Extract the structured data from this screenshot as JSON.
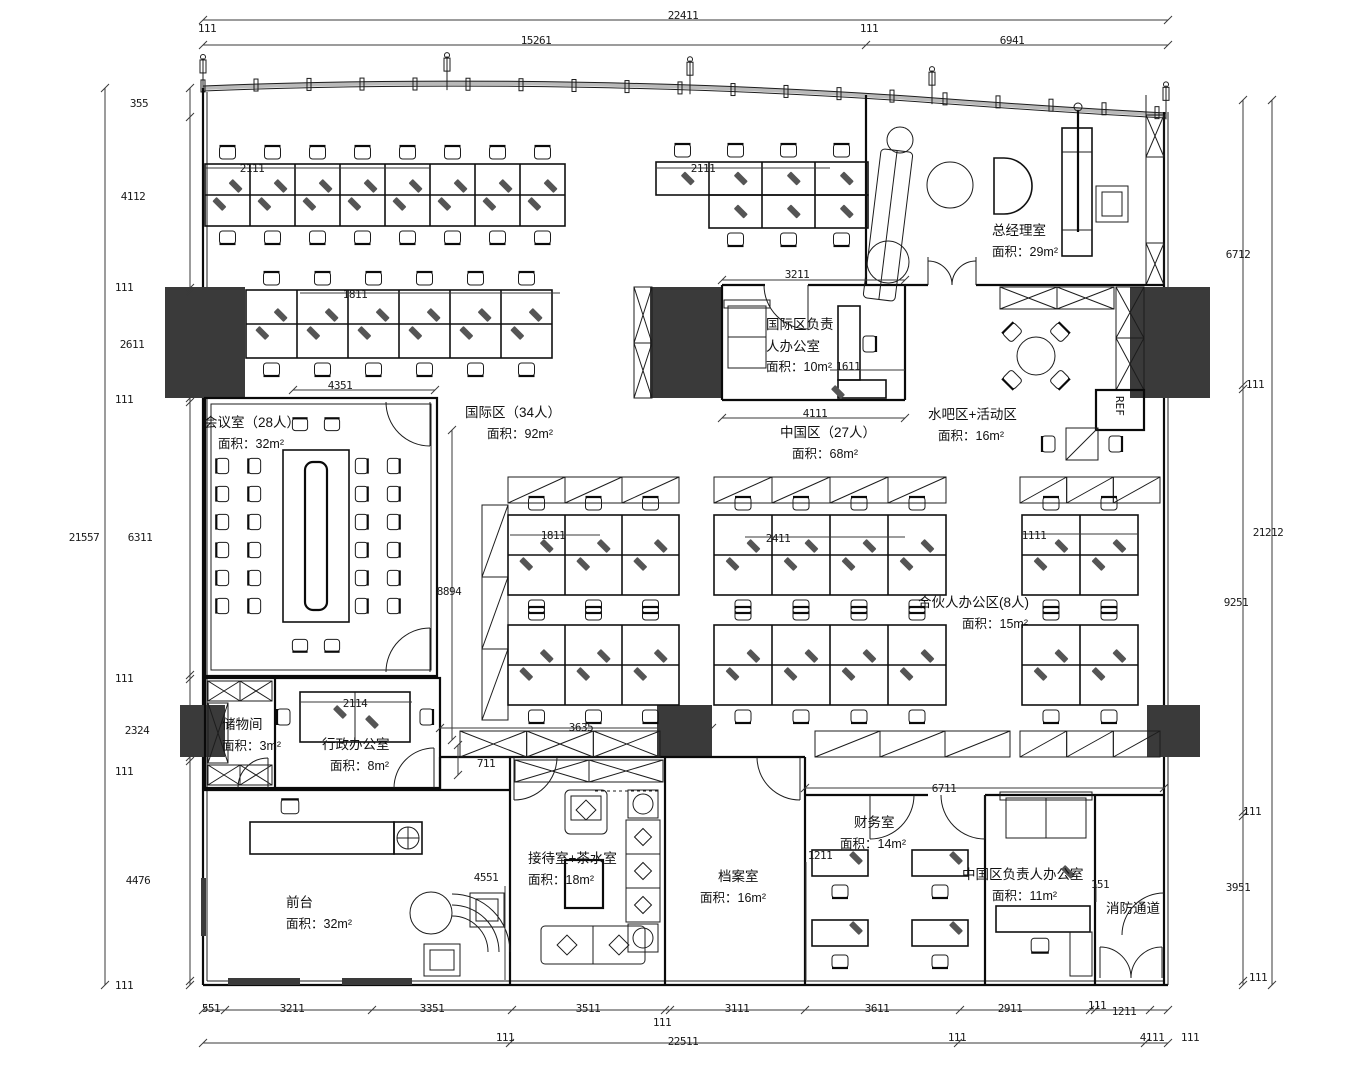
{
  "drawing": {
    "type": "office floor plan",
    "language": "zh-CN"
  },
  "rooms": [
    {
      "id": "general-manager",
      "name": "总经理室",
      "area": "面积：29m²"
    },
    {
      "id": "intl-manager",
      "name_line1": "国际区负责",
      "name_line2": "人办公室",
      "area": "面积：10m²"
    },
    {
      "id": "water-bar",
      "name": "水吧区+活动区",
      "area": "面积：16m²"
    },
    {
      "id": "international-zone",
      "name": "国际区（34人）",
      "area": "面积：92m²"
    },
    {
      "id": "china-zone",
      "name": "中国区（27人）",
      "area": "面积：68m²"
    },
    {
      "id": "meeting-room",
      "name": "会议室（28人）",
      "area": "面积：32m²"
    },
    {
      "id": "partner-office",
      "name": "合伙人办公区(8人)",
      "area": "面积：15m²"
    },
    {
      "id": "storage-room",
      "name": "储物间",
      "area": "面积：3m²"
    },
    {
      "id": "admin-office",
      "name": "行政办公室",
      "area": "面积：8m²"
    },
    {
      "id": "front-desk",
      "name": "前台",
      "area": "面积：32m²"
    },
    {
      "id": "guest-tea-room",
      "name": "接待室+茶水室",
      "area": "面积：18m²"
    },
    {
      "id": "archive-room",
      "name": "档案室",
      "area": "面积：16m²"
    },
    {
      "id": "finance-room",
      "name": "财务室",
      "area": "面积：14m²"
    },
    {
      "id": "china-manager",
      "name": "中国区负责人办公室",
      "area": "面积：11m²"
    },
    {
      "id": "fire-exit",
      "name": "消防通道"
    }
  ],
  "appliances": {
    "fridge_label": "REF"
  },
  "dimension_labels": [
    {
      "t": "22411",
      "x": 683,
      "y": 9
    },
    {
      "t": "111",
      "x": 207,
      "y": 22
    },
    {
      "t": "111",
      "x": 869,
      "y": 22
    },
    {
      "t": "15261",
      "x": 536,
      "y": 34
    },
    {
      "t": "6941",
      "x": 1012,
      "y": 34
    },
    {
      "t": "355",
      "x": 139,
      "y": 97
    },
    {
      "t": "4112",
      "x": 133,
      "y": 190
    },
    {
      "t": "111",
      "x": 124,
      "y": 281
    },
    {
      "t": "2611",
      "x": 132,
      "y": 338
    },
    {
      "t": "111",
      "x": 124,
      "y": 393
    },
    {
      "t": "21557",
      "x": 84,
      "y": 531
    },
    {
      "t": "6311",
      "x": 140,
      "y": 531
    },
    {
      "t": "111",
      "x": 124,
      "y": 672
    },
    {
      "t": "2324",
      "x": 137,
      "y": 724
    },
    {
      "t": "111",
      "x": 124,
      "y": 765
    },
    {
      "t": "4476",
      "x": 138,
      "y": 874
    },
    {
      "t": "111",
      "x": 124,
      "y": 979
    },
    {
      "t": "6712",
      "x": 1238,
      "y": 248
    },
    {
      "t": "111",
      "x": 1255,
      "y": 378
    },
    {
      "t": "21212",
      "x": 1268,
      "y": 526
    },
    {
      "t": "9251",
      "x": 1236,
      "y": 596
    },
    {
      "t": "111",
      "x": 1252,
      "y": 805
    },
    {
      "t": "3951",
      "x": 1238,
      "y": 881
    },
    {
      "t": "111",
      "x": 1258,
      "y": 971
    },
    {
      "t": "551",
      "x": 211,
      "y": 1002
    },
    {
      "t": "3211",
      "x": 292,
      "y": 1002
    },
    {
      "t": "3351",
      "x": 432,
      "y": 1002
    },
    {
      "t": "3511",
      "x": 588,
      "y": 1002
    },
    {
      "t": "111",
      "x": 662,
      "y": 1016
    },
    {
      "t": "3111",
      "x": 737,
      "y": 1002
    },
    {
      "t": "3611",
      "x": 877,
      "y": 1002
    },
    {
      "t": "2911",
      "x": 1010,
      "y": 1002
    },
    {
      "t": "111",
      "x": 1097,
      "y": 999
    },
    {
      "t": "1211",
      "x": 1124,
      "y": 1005
    },
    {
      "t": "111",
      "x": 505,
      "y": 1031
    },
    {
      "t": "22511",
      "x": 683,
      "y": 1035
    },
    {
      "t": "111",
      "x": 957,
      "y": 1031
    },
    {
      "t": "4111",
      "x": 1152,
      "y": 1031
    },
    {
      "t": "111",
      "x": 1190,
      "y": 1031
    },
    {
      "t": "2111",
      "x": 252,
      "y": 162
    },
    {
      "t": "2111",
      "x": 703,
      "y": 162
    },
    {
      "t": "1811",
      "x": 355,
      "y": 288
    },
    {
      "t": "3211",
      "x": 797,
      "y": 268
    },
    {
      "t": "1611",
      "x": 848,
      "y": 360
    },
    {
      "t": "4111",
      "x": 815,
      "y": 407
    },
    {
      "t": "4351",
      "x": 340,
      "y": 379
    },
    {
      "t": "8894",
      "x": 449,
      "y": 585
    },
    {
      "t": "1811",
      "x": 553,
      "y": 529
    },
    {
      "t": "2411",
      "x": 778,
      "y": 532
    },
    {
      "t": "1111",
      "x": 1034,
      "y": 529
    },
    {
      "t": "3635",
      "x": 581,
      "y": 721
    },
    {
      "t": "711",
      "x": 486,
      "y": 757
    },
    {
      "t": "2114",
      "x": 355,
      "y": 697
    },
    {
      "t": "4551",
      "x": 486,
      "y": 871
    },
    {
      "t": "1211",
      "x": 820,
      "y": 849
    },
    {
      "t": "6711",
      "x": 944,
      "y": 782
    },
    {
      "t": "151",
      "x": 1100,
      "y": 878
    }
  ]
}
